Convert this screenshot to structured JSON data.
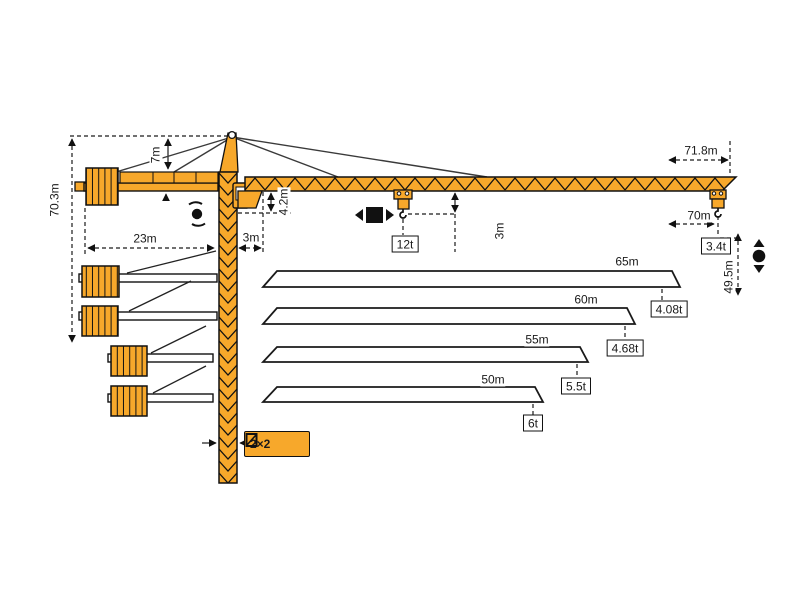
{
  "diagram": {
    "type": "tower-crane-specification-diagram",
    "colors": {
      "crane_orange": "#F7A82B",
      "outline": "#1A1A1A"
    },
    "dims": {
      "total_height": "70.3m",
      "apex_offset": "7m",
      "counterjib_length": "23m",
      "rear_clearance": "3m",
      "jib_root_depth": "4.2m",
      "hook_offset": "3m",
      "overall_jib": "71.8m",
      "working_radius": "70m",
      "hook_height": "49.5m"
    },
    "loads": {
      "max": "12t",
      "tip": "3.4t"
    },
    "mast": {
      "section": "2×2"
    },
    "jib_options": [
      {
        "length": "65m",
        "tip_load": "4.08t"
      },
      {
        "length": "60m",
        "tip_load": "4.68t"
      },
      {
        "length": "55m",
        "tip_load": "5.5t"
      },
      {
        "length": "50m",
        "tip_load": "6t"
      }
    ]
  }
}
